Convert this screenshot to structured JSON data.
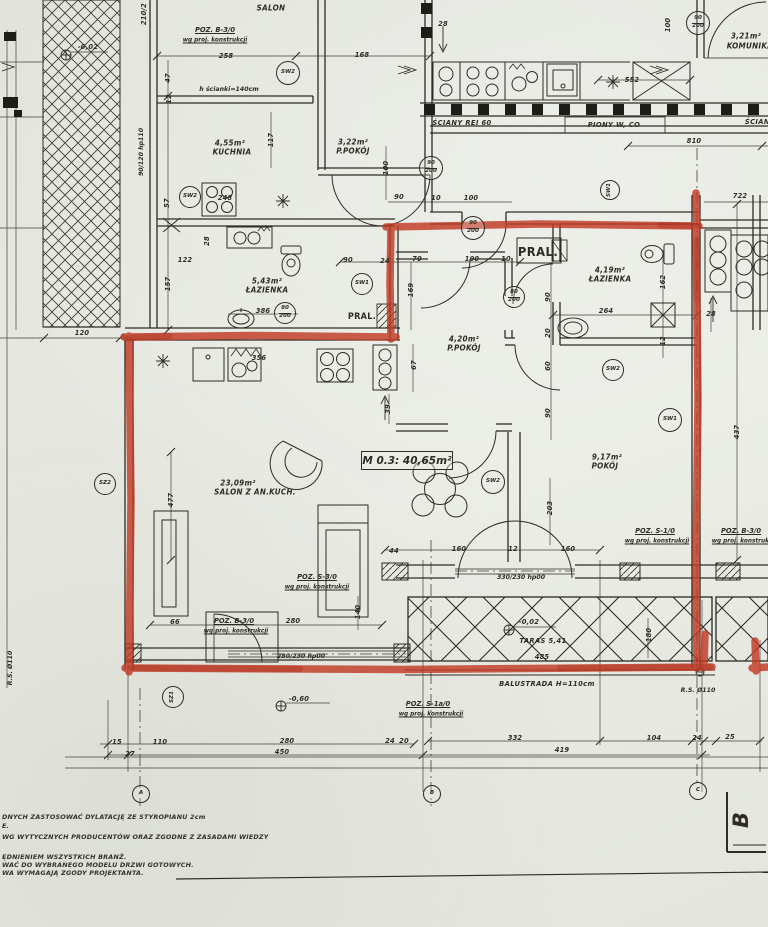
{
  "meta": {
    "description": "Scanned architectural floor plan with apartment M 0.3 outlined in red marker",
    "paper_color": "#e5e7e0",
    "ink_color": "#2e2c24",
    "marker_color": "#c13a25"
  },
  "unit_label": "M 0.3: 40,65m²",
  "section_marker": "B",
  "labels": [
    {
      "t": "SALON",
      "x": 271,
      "y": 8,
      "c": "room"
    },
    {
      "t": "POZ. B-3/0",
      "x": 215,
      "y": 30,
      "c": "poz"
    },
    {
      "t": "wg proj. konstrukcji",
      "x": 215,
      "y": 40,
      "c": "sub"
    },
    {
      "t": "258",
      "x": 226,
      "y": 56,
      "c": "dim"
    },
    {
      "t": "168",
      "x": 362,
      "y": 55,
      "c": "dim"
    },
    {
      "t": "h ścianki=140cm",
      "x": 229,
      "y": 89,
      "c": "small"
    },
    {
      "t": "4,55m²",
      "x": 230,
      "y": 143,
      "c": "room"
    },
    {
      "t": "KUCHNIA",
      "x": 232,
      "y": 152,
      "c": "room"
    },
    {
      "t": "117",
      "x": 271,
      "y": 140,
      "r": -90,
      "c": "dim"
    },
    {
      "t": "3,22m²",
      "x": 353,
      "y": 142,
      "c": "room"
    },
    {
      "t": "P.POKÓJ",
      "x": 353,
      "y": 151,
      "c": "room"
    },
    {
      "t": "100",
      "x": 386,
      "y": 168,
      "r": -90,
      "c": "dim"
    },
    {
      "t": "28",
      "x": 443,
      "y": 24,
      "c": "dim"
    },
    {
      "t": "100",
      "x": 668,
      "y": 25,
      "r": -90,
      "c": "dim"
    },
    {
      "t": "3,21m²",
      "x": 746,
      "y": 36,
      "c": "room"
    },
    {
      "t": "KOMUNIKACJA",
      "x": 757,
      "y": 46,
      "c": "room"
    },
    {
      "t": "552",
      "x": 632,
      "y": 80,
      "c": "dim"
    },
    {
      "t": "ŚCIANY REI 60",
      "x": 462,
      "y": 123,
      "c": "smi"
    },
    {
      "t": "PIONY W, CO",
      "x": 614,
      "y": 125,
      "c": "smi"
    },
    {
      "t": "ŚCIANY",
      "x": 760,
      "y": 122,
      "c": "smi"
    },
    {
      "t": "810",
      "x": 694,
      "y": 141,
      "c": "dim"
    },
    {
      "t": "722",
      "x": 740,
      "y": 196,
      "c": "dim"
    },
    {
      "t": "-0,02",
      "x": 88,
      "y": 47,
      "c": "dim"
    },
    {
      "t": "210/2",
      "x": 144,
      "y": 14,
      "r": -90,
      "c": "dim"
    },
    {
      "t": "90/120 hp110",
      "x": 141,
      "y": 152,
      "r": -90,
      "c": "small"
    },
    {
      "t": "47",
      "x": 168,
      "y": 78,
      "r": -90,
      "c": "dim"
    },
    {
      "t": "12",
      "x": 169,
      "y": 99,
      "r": -90,
      "c": "dim"
    },
    {
      "t": "57",
      "x": 167,
      "y": 203,
      "r": -90,
      "c": "dim"
    },
    {
      "t": "122",
      "x": 185,
      "y": 260,
      "c": "dim"
    },
    {
      "t": "157",
      "x": 168,
      "y": 284,
      "r": -90,
      "c": "dim"
    },
    {
      "t": "248",
      "x": 225,
      "y": 198,
      "c": "dim"
    },
    {
      "t": "28",
      "x": 207,
      "y": 241,
      "r": -90,
      "c": "dim"
    },
    {
      "t": "5,43m²",
      "x": 267,
      "y": 281,
      "c": "room"
    },
    {
      "t": "ŁAZIENKA",
      "x": 267,
      "y": 290,
      "c": "room"
    },
    {
      "t": "386",
      "x": 263,
      "y": 311,
      "c": "dim"
    },
    {
      "t": "PRAL.",
      "x": 362,
      "y": 317,
      "c": "pral"
    },
    {
      "t": "90",
      "x": 348,
      "y": 260,
      "c": "dim"
    },
    {
      "t": "24",
      "x": 385,
      "y": 261,
      "c": "dim"
    },
    {
      "t": "90",
      "x": 399,
      "y": 197,
      "c": "dim"
    },
    {
      "t": "10",
      "x": 436,
      "y": 198,
      "c": "dim"
    },
    {
      "t": "100",
      "x": 471,
      "y": 198,
      "c": "dim"
    },
    {
      "t": "70",
      "x": 417,
      "y": 259,
      "c": "dim"
    },
    {
      "t": "100",
      "x": 472,
      "y": 259,
      "c": "dim"
    },
    {
      "t": "10",
      "x": 506,
      "y": 259,
      "c": "dim"
    },
    {
      "t": "169",
      "x": 411,
      "y": 290,
      "r": -90,
      "c": "dim"
    },
    {
      "t": "67",
      "x": 414,
      "y": 365,
      "r": -90,
      "c": "dim"
    },
    {
      "t": "39",
      "x": 388,
      "y": 409,
      "r": -90,
      "c": "dim"
    },
    {
      "t": "356",
      "x": 259,
      "y": 358,
      "c": "dim"
    },
    {
      "t": "PRAL.",
      "x": 538,
      "y": 252,
      "c": "pralbig"
    },
    {
      "t": "4,19m²",
      "x": 610,
      "y": 270,
      "c": "room"
    },
    {
      "t": "ŁAZIENKA",
      "x": 610,
      "y": 279,
      "c": "room"
    },
    {
      "t": "264",
      "x": 606,
      "y": 311,
      "c": "dim"
    },
    {
      "t": "90",
      "x": 548,
      "y": 297,
      "r": -90,
      "c": "dim"
    },
    {
      "t": "20",
      "x": 548,
      "y": 333,
      "r": -90,
      "c": "dim"
    },
    {
      "t": "60",
      "x": 548,
      "y": 366,
      "r": -90,
      "c": "dim"
    },
    {
      "t": "90",
      "x": 548,
      "y": 413,
      "r": -90,
      "c": "dim"
    },
    {
      "t": "162",
      "x": 663,
      "y": 282,
      "r": -90,
      "c": "dim"
    },
    {
      "t": "12",
      "x": 663,
      "y": 341,
      "r": -90,
      "c": "dim"
    },
    {
      "t": "28",
      "x": 711,
      "y": 314,
      "c": "dim"
    },
    {
      "t": "437",
      "x": 737,
      "y": 432,
      "r": -90,
      "c": "dim"
    },
    {
      "t": "4,20m²",
      "x": 464,
      "y": 339,
      "c": "room"
    },
    {
      "t": "P.POKÓJ",
      "x": 464,
      "y": 348,
      "c": "room"
    },
    {
      "t": "23,09m²",
      "x": 238,
      "y": 483,
      "c": "room"
    },
    {
      "t": "SALON Z AN.KUCH.",
      "x": 255,
      "y": 492,
      "c": "room"
    },
    {
      "t": "9,17m²",
      "x": 607,
      "y": 457,
      "c": "room"
    },
    {
      "t": "POKÓJ",
      "x": 605,
      "y": 466,
      "c": "room"
    },
    {
      "t": "203",
      "x": 550,
      "y": 508,
      "r": -90,
      "c": "dim"
    },
    {
      "t": "477",
      "x": 171,
      "y": 500,
      "r": -90,
      "c": "dim"
    },
    {
      "t": "120",
      "x": 82,
      "y": 333,
      "c": "dim"
    },
    {
      "t": "POZ. S-3/0",
      "x": 317,
      "y": 577,
      "c": "poz"
    },
    {
      "t": "wg proj. konstrukcji",
      "x": 317,
      "y": 587,
      "c": "sub"
    },
    {
      "t": "POZ. S-1/0",
      "x": 655,
      "y": 531,
      "c": "poz"
    },
    {
      "t": "wg proj. konstrukcji",
      "x": 657,
      "y": 541,
      "c": "sub"
    },
    {
      "t": "POZ. B-3/0",
      "x": 741,
      "y": 531,
      "c": "poz"
    },
    {
      "t": "wg proj. konstrukcji",
      "x": 744,
      "y": 541,
      "c": "sub"
    },
    {
      "t": "44",
      "x": 394,
      "y": 551,
      "c": "dim"
    },
    {
      "t": "160",
      "x": 459,
      "y": 549,
      "c": "dim"
    },
    {
      "t": "12",
      "x": 513,
      "y": 549,
      "c": "dim"
    },
    {
      "t": "160",
      "x": 568,
      "y": 549,
      "c": "dim"
    },
    {
      "t": "330/230 hp00",
      "x": 521,
      "y": 577,
      "c": "small"
    },
    {
      "t": "POZ. B-3/0",
      "x": 234,
      "y": 621,
      "c": "poz"
    },
    {
      "t": "wg proj. konstrukcji",
      "x": 236,
      "y": 631,
      "c": "sub"
    },
    {
      "t": "280",
      "x": 293,
      "y": 621,
      "c": "dim"
    },
    {
      "t": "66",
      "x": 175,
      "y": 622,
      "c": "dim"
    },
    {
      "t": "140",
      "x": 358,
      "y": 612,
      "r": -90,
      "c": "dim"
    },
    {
      "t": "280/230 hp00",
      "x": 301,
      "y": 656,
      "c": "small"
    },
    {
      "t": "-0,60",
      "x": 299,
      "y": 699,
      "c": "dim"
    },
    {
      "t": "-0,02",
      "x": 529,
      "y": 622,
      "c": "dim"
    },
    {
      "t": "TARAS 5,41",
      "x": 543,
      "y": 641,
      "c": "smi"
    },
    {
      "t": "485",
      "x": 542,
      "y": 657,
      "c": "dim"
    },
    {
      "t": "180",
      "x": 649,
      "y": 635,
      "r": -90,
      "c": "dim"
    },
    {
      "t": "BALUSTRADA H=110cm",
      "x": 547,
      "y": 684,
      "c": "smi"
    },
    {
      "t": "R.S. Ø110",
      "x": 698,
      "y": 690,
      "c": "small"
    },
    {
      "t": "POZ. S-1a/0",
      "x": 428,
      "y": 704,
      "c": "poz"
    },
    {
      "t": "wg proj. konstrukcji",
      "x": 431,
      "y": 714,
      "c": "sub"
    },
    {
      "t": "15",
      "x": 117,
      "y": 742,
      "c": "dim"
    },
    {
      "t": "110",
      "x": 160,
      "y": 742,
      "c": "dim"
    },
    {
      "t": "280",
      "x": 287,
      "y": 741,
      "c": "dim"
    },
    {
      "t": "24",
      "x": 390,
      "y": 741,
      "c": "dim"
    },
    {
      "t": "20",
      "x": 404,
      "y": 741,
      "c": "dim"
    },
    {
      "t": "332",
      "x": 515,
      "y": 738,
      "c": "dim"
    },
    {
      "t": "104",
      "x": 654,
      "y": 738,
      "c": "dim"
    },
    {
      "t": "24",
      "x": 697,
      "y": 738,
      "c": "dim"
    },
    {
      "t": "25",
      "x": 730,
      "y": 737,
      "c": "dim"
    },
    {
      "t": "27",
      "x": 130,
      "y": 754,
      "c": "dim"
    },
    {
      "t": "450",
      "x": 282,
      "y": 752,
      "c": "dim"
    },
    {
      "t": "419",
      "x": 562,
      "y": 750,
      "c": "dim"
    },
    {
      "t": "R.S. Ø110",
      "x": 10,
      "y": 668,
      "r": -90,
      "c": "small"
    }
  ],
  "circles": [
    {
      "lines": [
        "SW2"
      ],
      "x": 287,
      "y": 72,
      "r": 11
    },
    {
      "lines": [
        "90",
        "200"
      ],
      "x": 697,
      "y": 22,
      "r": 11
    },
    {
      "lines": [
        "90",
        "200"
      ],
      "x": 430,
      "y": 167,
      "r": 11
    },
    {
      "lines": [
        "SW1"
      ],
      "x": 609,
      "y": 189,
      "r": 9,
      "rot": -90
    },
    {
      "lines": [
        "SW2"
      ],
      "x": 189,
      "y": 196,
      "r": 10
    },
    {
      "lines": [
        "80",
        "200"
      ],
      "x": 284,
      "y": 312,
      "r": 10
    },
    {
      "lines": [
        "SW1"
      ],
      "x": 361,
      "y": 283,
      "r": 10
    },
    {
      "lines": [
        "90",
        "200"
      ],
      "x": 472,
      "y": 227,
      "r": 11
    },
    {
      "lines": [
        "80",
        "200"
      ],
      "x": 513,
      "y": 296,
      "r": 10
    },
    {
      "lines": [
        "SW2"
      ],
      "x": 612,
      "y": 369,
      "r": 10
    },
    {
      "lines": [
        "SW1"
      ],
      "x": 669,
      "y": 419,
      "r": 11
    },
    {
      "lines": [
        "SW2"
      ],
      "x": 492,
      "y": 481,
      "r": 11
    },
    {
      "lines": [
        "SZ2"
      ],
      "x": 104,
      "y": 483,
      "r": 10
    },
    {
      "lines": [
        "SZ1"
      ],
      "x": 172,
      "y": 696,
      "r": 10,
      "rot": -90
    },
    {
      "lines": [
        "A"
      ],
      "x": 140,
      "y": 793,
      "r": 8
    },
    {
      "lines": [
        "B"
      ],
      "x": 431,
      "y": 793,
      "r": 8
    },
    {
      "lines": [
        "C"
      ],
      "x": 697,
      "y": 790,
      "r": 8
    }
  ],
  "notes": [
    {
      "t": "DNYCH ZASTOSOWAĆ DYLATACJĘ ZE STYROPIANU 2cm",
      "y": 813
    },
    {
      "t": "E.",
      "y": 822
    },
    {
      "t": "WG WYTYCZNYCH PRODUCENTÓW ORAZ ZGODNE Z ZASADAMI WIEDZY",
      "y": 833
    },
    {
      "t": "ĘDNIENIEM WSZYSTKICH BRANŻ.",
      "y": 853
    },
    {
      "t": "WAĆ DO WYBRANEGO MODELU DRZWI GOTOWYCH.",
      "y": 861
    },
    {
      "t": "WA WYMAGAJĄ ZGODY PROJEKTANTA.",
      "y": 869
    }
  ]
}
